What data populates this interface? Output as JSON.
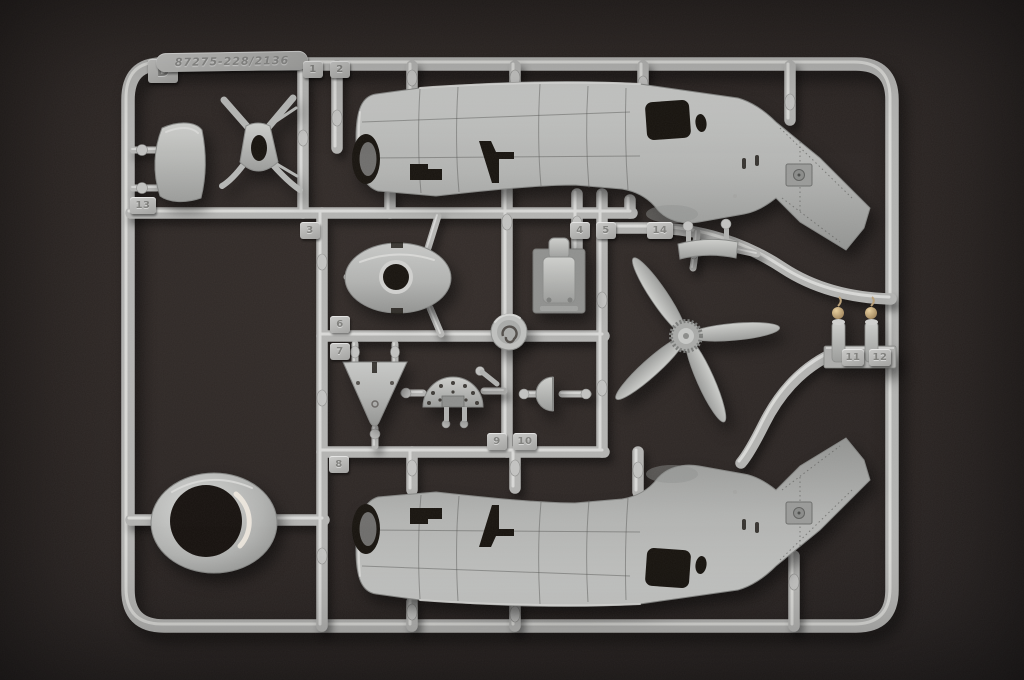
{
  "sprue": {
    "plate_letter": "D",
    "mold_number": "87275-228/2136",
    "part_tags": [
      {
        "label": "1",
        "x": 303,
        "y": 61,
        "w": 20
      },
      {
        "label": "2",
        "x": 330,
        "y": 61,
        "w": 20
      },
      {
        "label": "13",
        "x": 130,
        "y": 197,
        "w": 26
      },
      {
        "label": "3",
        "x": 300,
        "y": 222,
        "w": 20
      },
      {
        "label": "4",
        "x": 570,
        "y": 222,
        "w": 20
      },
      {
        "label": "5",
        "x": 596,
        "y": 222,
        "w": 20
      },
      {
        "label": "14",
        "x": 647,
        "y": 222,
        "w": 26
      },
      {
        "label": "6",
        "x": 330,
        "y": 316,
        "w": 20
      },
      {
        "label": "7",
        "x": 330,
        "y": 343,
        "w": 20
      },
      {
        "label": "11",
        "x": 842,
        "y": 349,
        "w": 22
      },
      {
        "label": "12",
        "x": 869,
        "y": 349,
        "w": 22
      },
      {
        "label": "9",
        "x": 487,
        "y": 433,
        "w": 20
      },
      {
        "label": "10",
        "x": 513,
        "y": 433,
        "w": 24
      },
      {
        "label": "8",
        "x": 329,
        "y": 456,
        "w": 20
      }
    ]
  },
  "colors": {
    "plastic": "#b3b3b1",
    "plastic_highlight": "#e2e2e0",
    "plastic_shadow": "#82827f",
    "background_dark": "#241f1d",
    "cutout": "#18140f"
  }
}
